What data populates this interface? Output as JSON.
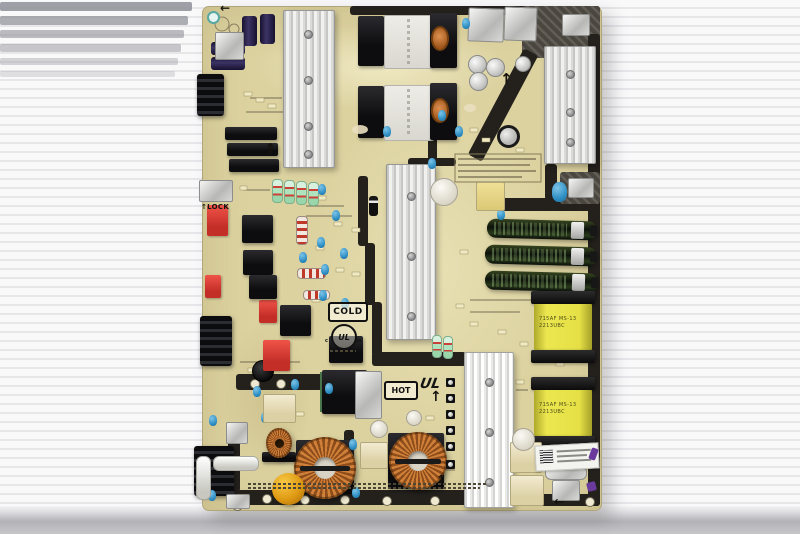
{
  "scene": {
    "subject": "Television power supply circuit board (PCB) photographed lying on a white corrugated sheet",
    "background_color": "#f2f2f4",
    "table_edge_color": "#b2b2b7"
  },
  "board": {
    "substrate_color": "#dcd2a0",
    "dark_silkscreen_color": "#24211d",
    "labels": {
      "lock": "LOCK",
      "cold": "COLD",
      "hot": "HOT"
    },
    "ul_mark": {
      "prefix": "c",
      "letters": "UL",
      "suffix": "us"
    },
    "yellow_transformer_marking": {
      "line1": "715AF MS-13",
      "line2": "2213UBC"
    },
    "icons": {
      "up_arrow": "↑",
      "left_arrow": "←"
    },
    "service_sticker": {
      "barcode": true
    },
    "component_colors": {
      "heatsink": "#dededc",
      "electrolytic_capacitor": "#16200f",
      "toroid_copper": "#c06a28",
      "film_capacitor_red": "#d93a30",
      "ceramic_capacitor_blue": "#3a96c8",
      "transformer_tape_yellow": "#e6e146",
      "thermistor_amber": "#df9913"
    },
    "components_visible": [
      "aluminum heatsinks",
      "switching transformers",
      "horizontal electrolytic capacitors",
      "yellow tape-wrapped transformers",
      "copper toroidal inductors",
      "relay blocks",
      "red film capacitors",
      "blue ceramic capacitors",
      "fuse",
      "edge connectors",
      "barcode service sticker"
    ]
  }
}
